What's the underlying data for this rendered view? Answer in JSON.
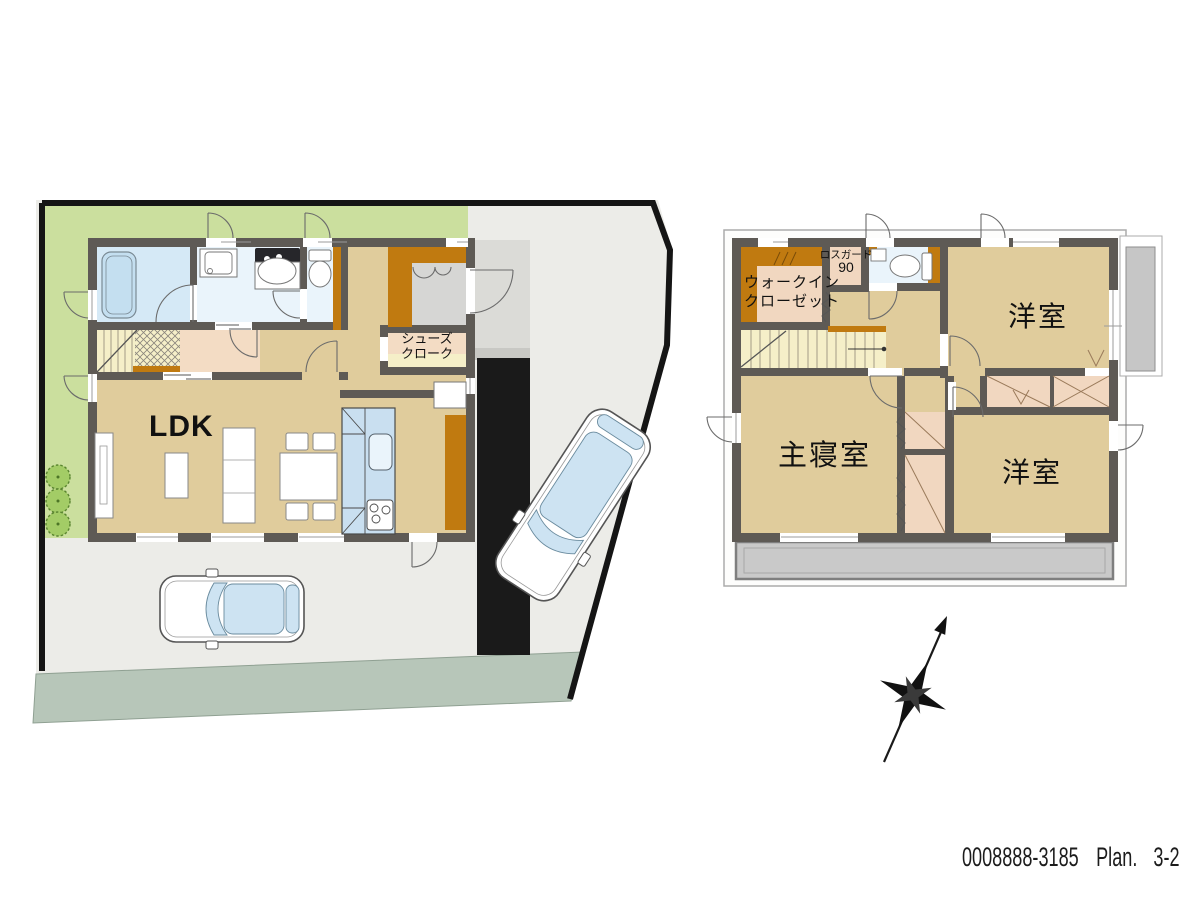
{
  "floor1": {
    "ldk_label": "LDK",
    "shoes_cloak_line1": "シューズ",
    "shoes_cloak_line2": "クローク"
  },
  "floor2": {
    "wic_line1": "ウォークイン",
    "wic_line2": "クローゼット",
    "lossguard_line1": "ロスガード",
    "lossguard_line2": "90",
    "master_bedroom": "主寝室",
    "western_room_top": "洋室",
    "western_room_bottom": "洋室"
  },
  "footer": {
    "code": "0008888-3185",
    "plan_label": "Plan.",
    "plan_value": "3-2"
  },
  "colors": {
    "floor_tan": "#E0CC9C",
    "stair_yellow": "#F5EFC8",
    "closet_pink": "#F1D7C0",
    "storage_orange": "#C07A10",
    "bath_blue": "#D5E9F6",
    "wet_floor_blue": "#EAF4FB",
    "kitchen_blue": "#C9DFF0",
    "wall_gray": "#5E5A55",
    "lawn_green": "#CBDF9E",
    "pavement_gray": "#ECECE8",
    "road_green_gray": "#B7C6B9",
    "approach_black": "#1A1A1A",
    "balcony_gray": "#C9C9C9"
  }
}
